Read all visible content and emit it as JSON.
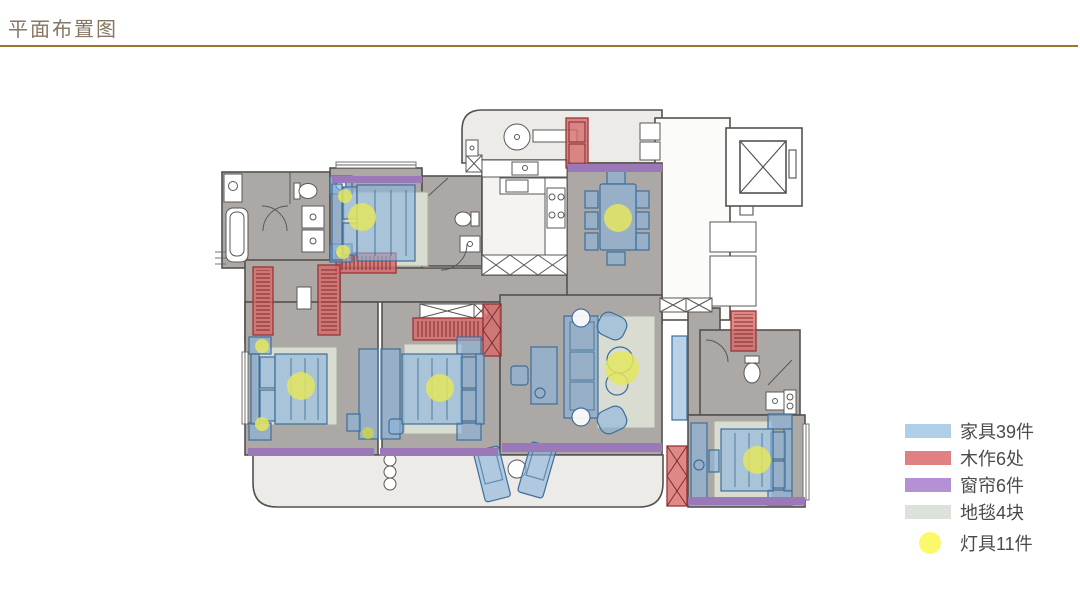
{
  "page": {
    "title": "平面布置图",
    "title_color": "#867664",
    "rule_color": "#9E752F"
  },
  "legend": {
    "items": [
      {
        "name": "furniture",
        "label": "家具39件",
        "color": "#AFCFE9",
        "shape": "rect"
      },
      {
        "name": "woodwork",
        "label": "木作6处",
        "color": "#E08082",
        "shape": "rect"
      },
      {
        "name": "curtains",
        "label": "窗帘6件",
        "color": "#B491D4",
        "shape": "rect"
      },
      {
        "name": "carpets",
        "label": "地毯4块",
        "color": "#DCE1DA",
        "shape": "rect"
      },
      {
        "name": "lights",
        "label": "灯具11件",
        "color": "#FBF96A",
        "shape": "circle"
      }
    ]
  },
  "floorplan": {
    "counts": {
      "furniture": 39,
      "woodwork": 6,
      "curtains": 6,
      "carpets": 4,
      "lights": 11
    },
    "overlay_colors": {
      "furniture": "#8CB4DC",
      "woodwork": "#D66A6A",
      "curtain": "#9B79B8",
      "carpet": "#D8DCD1",
      "light": "#E4E65F",
      "floor": "#ACA8A5",
      "balcony_floor": "#ECEBE8",
      "wall": "#55514E"
    }
  }
}
